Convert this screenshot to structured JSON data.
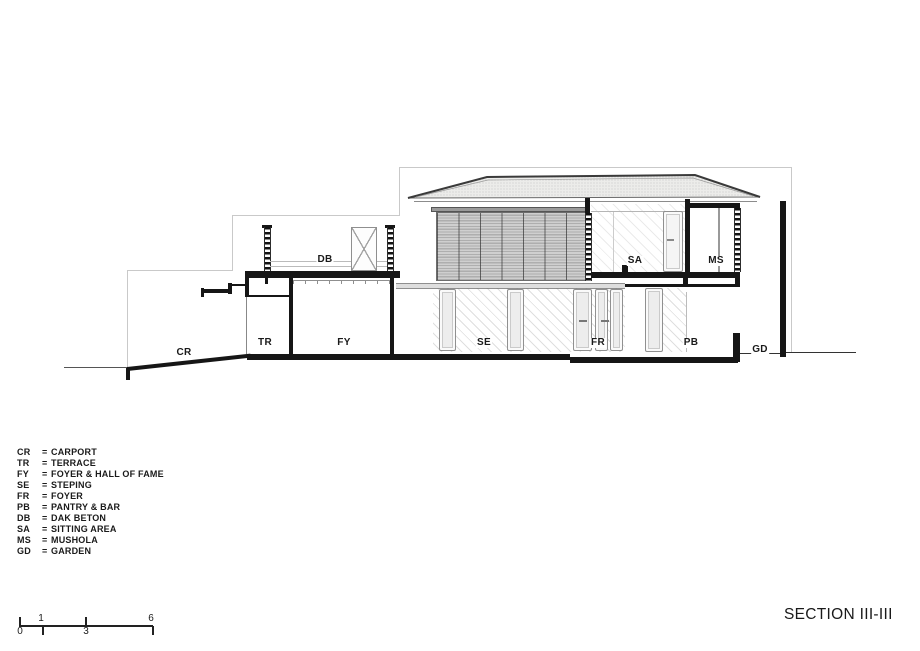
{
  "title": "SECTION III-III",
  "colors": {
    "ink": "#161616",
    "background_outline": "#c9c9c9",
    "roof_fill": "#ececea"
  },
  "labels": {
    "cr": "CR",
    "tr": "TR",
    "fy": "FY",
    "se": "SE",
    "fr": "FR",
    "pb": "PB",
    "db": "DB",
    "sa": "SA",
    "ms": "MS",
    "gd": "GD"
  },
  "legend": {
    "eq": "=",
    "rows": [
      {
        "abbr": "CR",
        "name": "CARPORT"
      },
      {
        "abbr": "TR",
        "name": "TERRACE"
      },
      {
        "abbr": "FY",
        "name": "FOYER & HALL OF FAME"
      },
      {
        "abbr": "SE",
        "name": "STEPING"
      },
      {
        "abbr": "FR",
        "name": "FOYER"
      },
      {
        "abbr": "PB",
        "name": "PANTRY & BAR"
      },
      {
        "abbr": "DB",
        "name": "DAK BETON"
      },
      {
        "abbr": "SA",
        "name": "SITTING AREA"
      },
      {
        "abbr": "MS",
        "name": "MUSHOLA"
      },
      {
        "abbr": "GD",
        "name": "GARDEN"
      }
    ]
  },
  "scale": {
    "n0": "0",
    "n1": "1",
    "n3": "3",
    "n6": "6"
  }
}
